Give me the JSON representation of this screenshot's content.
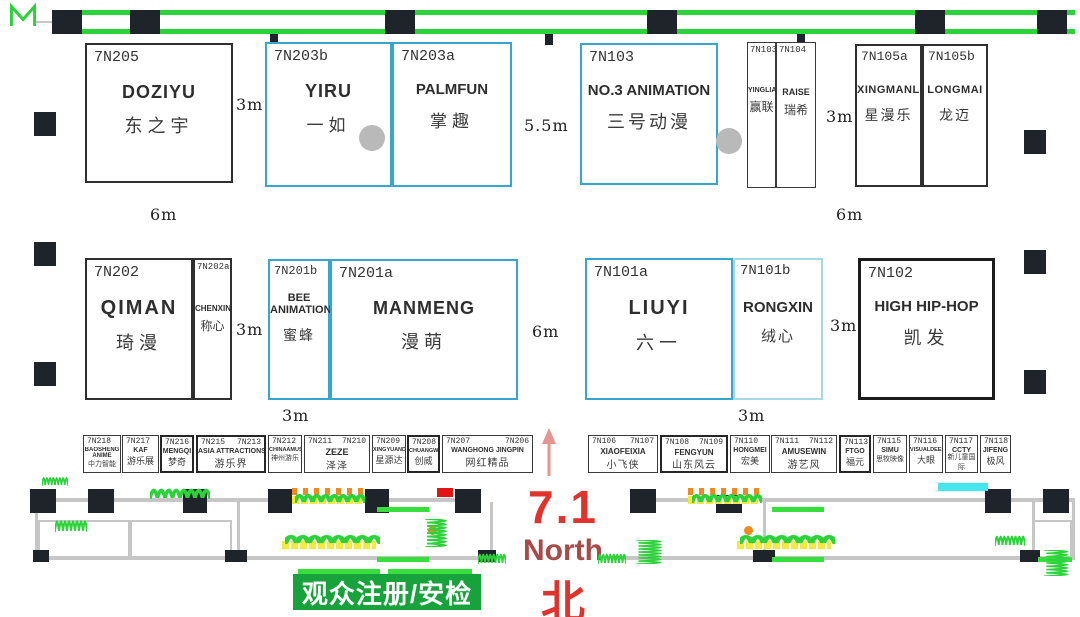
{
  "booths": {
    "top": [
      {
        "code": "7N205",
        "name": "DOZIYU",
        "cn": "东之宇"
      },
      {
        "code": "7N203b",
        "name": "YIRU",
        "cn": "一如"
      },
      {
        "code": "7N203a",
        "name": "PALMFUN",
        "cn": "掌趣"
      },
      {
        "code": "7N103",
        "name": "NO.3 ANIMATION",
        "cn": "三号动漫"
      },
      {
        "code": "7N103a",
        "name": "YINGLIAN",
        "cn": "赢联"
      },
      {
        "code": "7N104",
        "name": "RAISE",
        "cn": "瑞希"
      },
      {
        "code": "7N105a",
        "name": "XINGMANLE",
        "cn": "星漫乐"
      },
      {
        "code": "7N105b",
        "name": "LONGMAI",
        "cn": "龙迈"
      }
    ],
    "middle": [
      {
        "code": "7N202",
        "name": "QIMAN",
        "cn": "琦漫"
      },
      {
        "code": "7N202a",
        "name": "CHENXIN",
        "cn": "称心"
      },
      {
        "code": "7N201b",
        "name": "BEE ANIMATION",
        "cn": "蜜蜂"
      },
      {
        "code": "7N201a",
        "name": "MANMENG",
        "cn": "漫萌"
      },
      {
        "code": "7N101a",
        "name": "LIUYI",
        "cn": "六一"
      },
      {
        "code": "7N101b",
        "name": "RONGXIN",
        "cn": "绒心"
      },
      {
        "code": "7N102",
        "name": "HIGH HIP-HOP",
        "cn": "凯发"
      }
    ],
    "strip_left": [
      {
        "code": "7N218",
        "code2": "",
        "name": "BAOSHENG ANIME",
        "cn": "中力智能"
      },
      {
        "code": "7N217",
        "code2": "",
        "name": "KAF",
        "cn": "游乐展"
      },
      {
        "code": "7N216",
        "code2": "",
        "name": "MENGQI",
        "cn": "梦奇"
      },
      {
        "code": "7N215",
        "code2": "7N213",
        "name": "ASIA ATTRACTIONS",
        "cn": "游乐界"
      },
      {
        "code": "7N212",
        "code2": "",
        "name": "CHINAAMUSE",
        "cn": "神州游乐"
      },
      {
        "code": "7N211",
        "code2": "7N210",
        "name": "ZEZE",
        "cn": "泽泽"
      },
      {
        "code": "7N209",
        "code2": "",
        "name": "XINGYUANDA",
        "cn": "星源达"
      },
      {
        "code": "7N208",
        "code2": "",
        "name": "CHUANGWEI",
        "cn": "创威"
      },
      {
        "code": "7N207",
        "code2": "7N206",
        "name": "WANGHONG JINGPIN",
        "cn": "网红精品"
      }
    ],
    "strip_right": [
      {
        "code": "7N106",
        "code2": "7N107",
        "name": "XIAOFEIXIA",
        "cn": "小飞侠"
      },
      {
        "code": "7N108",
        "code2": "7N109",
        "name": "FENGYUN",
        "cn": "山东风云"
      },
      {
        "code": "7N110",
        "code2": "",
        "name": "HONGMEI",
        "cn": "宏美"
      },
      {
        "code": "7N111",
        "code2": "7N112",
        "name": "AMUSEWIN",
        "cn": "游艺风"
      },
      {
        "code": "7N113",
        "code2": "",
        "name": "FTGO",
        "cn": "福元"
      },
      {
        "code": "7N115",
        "code2": "",
        "name": "SIMU",
        "cn": "思牧映像"
      },
      {
        "code": "7N116",
        "code2": "",
        "name": "VISUALDEEP",
        "cn": "大眼"
      },
      {
        "code": "7N117",
        "code2": "",
        "name": "CCTY",
        "cn": "新儿童国际"
      },
      {
        "code": "7N118",
        "code2": "",
        "name": "JIFENG",
        "cn": "极风"
      }
    ]
  },
  "dims": {
    "top_left": "3m",
    "top_center": "5.5m",
    "top_right": "3m",
    "mid_left_6m": "6m",
    "mid_right_6m": "6m",
    "row2_left": "3m",
    "row2_center": "6m",
    "row2_right": "3m",
    "bottom_left": "3m",
    "bottom_right": "3m"
  },
  "compass": {
    "hall": "7.1",
    "direction": "North",
    "direction_cn": "北"
  },
  "entrance_badge": "观众注册/安检",
  "colors": {
    "booth_border_black": "#2f2f2f",
    "booth_border_blue": "#36a6ca",
    "booth_border_light_blue": "#a6d8e2",
    "wall_green": "#2bd23a",
    "badge_green": "#18a23c",
    "compass_red": "#e0332b",
    "compass_dark_red": "#a64a4a",
    "gate_yellow": "#f3ea3c",
    "gate_orange": "#f08a1e",
    "highlight_cyan": "#45e6ee"
  }
}
